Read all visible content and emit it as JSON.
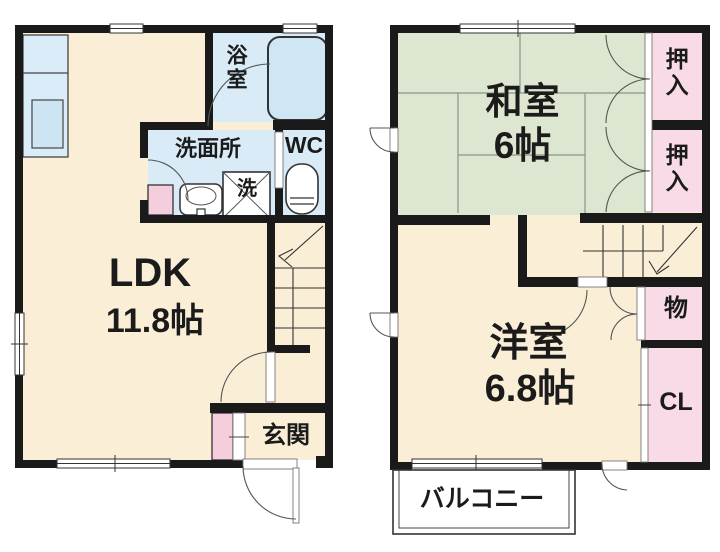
{
  "colors": {
    "floor": "#faeed6",
    "tatami": "#dde6d1",
    "wet": "#d8ebf7",
    "tub": "#cfe6f4",
    "counter": "#d9ecf8",
    "countersink": "#cde4f2",
    "closet_pink": "#f8dbe6",
    "cabinet_pink": "#f5cede",
    "wall": "#1a1a1a",
    "line": "#444444",
    "thinline": "#777777",
    "tatami_line": "#8a9684",
    "text": "#1b1b1b"
  },
  "floor1": {
    "ldk": {
      "name": "LDK",
      "size": "11.8帖"
    },
    "bath": "浴室",
    "washroom": "洗面所",
    "wc": "WC",
    "laundry": "洗",
    "entrance": "玄関"
  },
  "floor2": {
    "washitsu": {
      "name": "和室",
      "size": "6帖"
    },
    "oshiire_top": "押入",
    "oshiire_bottom": "押入",
    "youshitsu": {
      "name": "洋室",
      "size": "6.8帖"
    },
    "storage": "物",
    "closet": "CL",
    "balcony": "バルコニー"
  }
}
